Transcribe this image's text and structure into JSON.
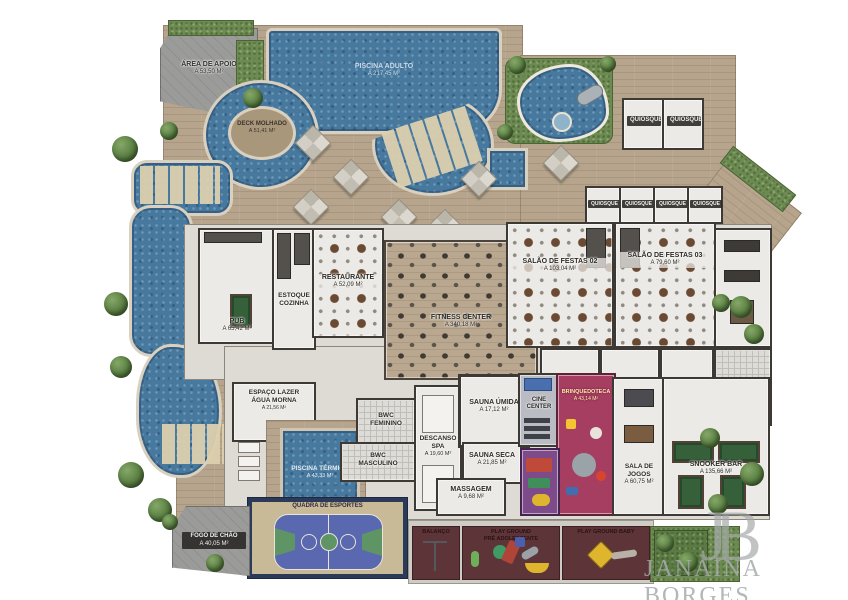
{
  "brand": {
    "monogram": "JB",
    "name": "JANAINA BORGES"
  },
  "colors": {
    "water": "#47799f",
    "deck": "#b6a58c",
    "lawn": "#6d8a52",
    "playground_floor": "#5d3538",
    "brinquedoteca": "#a63e62",
    "court_blue": "#5a68b0",
    "court_green": "#5f9465",
    "court_border": "#2c3a5a"
  },
  "labels": {
    "area_apoio": {
      "name": "ÁREA DE APOIO",
      "area": "A 53,50 M²"
    },
    "piscina_adulto": {
      "name": "PISCINA ADULTO",
      "area": "A 217,45 M²"
    },
    "deck_molhado": {
      "name": "DECK MOLHADO",
      "area": "A 51,41 M²"
    },
    "restaurante": {
      "name": "RESTAURANTE",
      "area": "A 52,09 M²"
    },
    "estoque": {
      "line1": "ESTOQUE",
      "line2": "COZINHA"
    },
    "pub": {
      "name": "PUB",
      "area": "A 65,42 M²"
    },
    "fitness": {
      "name": "FITNESS CENTER",
      "area": "A 340,18 M²"
    },
    "salao2": {
      "name": "SALÃO DE FESTAS 02",
      "area": "A 103,04 M²"
    },
    "salao3": {
      "name": "SALÃO DE FESTAS 03",
      "area": "A 79,60 M²"
    },
    "quiosque": {
      "name": "QUIOSQUE"
    },
    "espaco_lazer": {
      "line1": "ESPAÇO LAZER",
      "line2": "ÁGUA MORNA",
      "area": "A 21,56 M²"
    },
    "piscina_termica": {
      "name": "PISCINA TÉRMICA",
      "area": "A 43,33 M²"
    },
    "bwc_fem": {
      "line1": "BWC",
      "line2": "FEMININO"
    },
    "bwc_masc": {
      "line1": "BWC",
      "line2": "MASCULINO"
    },
    "descanso_spa": {
      "line1": "DESCANSO",
      "line2": "SPA",
      "area": "A 19,60 M²"
    },
    "sauna_umida": {
      "name": "SAUNA ÚMIDA",
      "area": "A 17,12 M²"
    },
    "sauna_seca": {
      "name": "SAUNA SECA",
      "area": "A 21,85 M²"
    },
    "massagem": {
      "name": "MASSAGEM",
      "area": "A 9,68 M²"
    },
    "cine": {
      "name": "CINE CENTER"
    },
    "brinquedoteca": {
      "name": "BRINQUEDOTECA",
      "area": "A 43,14 M²"
    },
    "sala_jogos": {
      "name": "SALA DE JOGOS",
      "area": "A 60,75 M²"
    },
    "snooker": {
      "name": "SNOOKER BAR",
      "area": "A 135,66 M²"
    },
    "quadra": {
      "name": "QUADRA DE ESPORTES"
    },
    "balanco": {
      "name": "BALANÇO"
    },
    "play_pre": {
      "line1": "PLAY GROUND",
      "line2": "PRÉ ADOLESCENTE"
    },
    "play_baby": {
      "name": "PLAY GROUND BABY"
    },
    "fogo_chao": {
      "name": "FOGO DE CHÃO",
      "area": "A 40,05 M²"
    }
  }
}
